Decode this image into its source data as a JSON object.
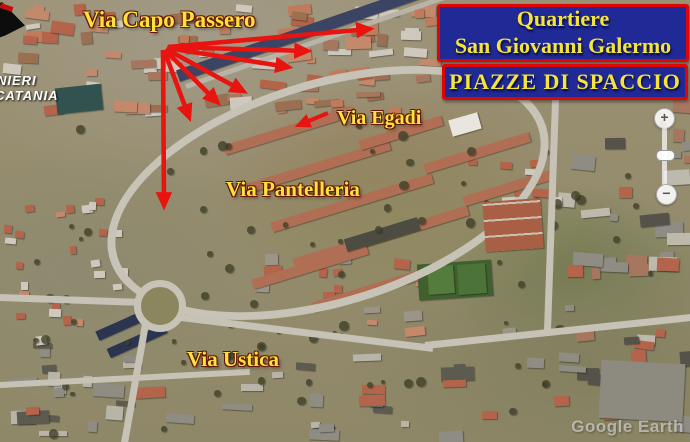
{
  "header": {
    "district_box": {
      "line1": "Quartiere",
      "line2": "San Giovanni Galermo"
    },
    "subtitle_box": {
      "label": "PIAZZE DI SPACCIO"
    },
    "colors": {
      "box_bg": "#202a96",
      "box_border": "#e00505",
      "box_text": "#f6e538"
    }
  },
  "map": {
    "street_labels": [
      {
        "id": "via-capo-passero",
        "text": "Via Capo Passero"
      },
      {
        "id": "via-egadi",
        "text": "Via Egadi"
      },
      {
        "id": "via-pantelleria",
        "text": "Via Pantelleria"
      },
      {
        "id": "via-ustica",
        "text": "Via Ustica"
      }
    ],
    "corner_text": {
      "line1": "NIERI",
      "line2": "CATANIA"
    },
    "watermark": "Google Earth"
  },
  "annotations": {
    "arrow_color": "#e81410",
    "arrows": [
      {
        "x1": 168,
        "y1": 47,
        "x2": 369,
        "y2": 29,
        "w": 4.6
      },
      {
        "x1": 168,
        "y1": 47,
        "x2": 307,
        "y2": 51,
        "w": 4.6
      },
      {
        "x1": 167,
        "y1": 48,
        "x2": 288,
        "y2": 67,
        "w": 4.6
      },
      {
        "x1": 166,
        "y1": 49,
        "x2": 243,
        "y2": 91,
        "w": 4.6
      },
      {
        "x1": 165,
        "y1": 50,
        "x2": 217,
        "y2": 102,
        "w": 4.6
      },
      {
        "x1": 164,
        "y1": 50,
        "x2": 189,
        "y2": 117,
        "w": 4.6
      },
      {
        "x1": 163,
        "y1": 50,
        "x2": 164,
        "y2": 205,
        "w": 4.6
      },
      {
        "x1": 328,
        "y1": 113,
        "x2": 299,
        "y2": 125,
        "w": 4
      }
    ]
  },
  "controls": {
    "zoom_in": "+",
    "zoom_out": "−"
  }
}
